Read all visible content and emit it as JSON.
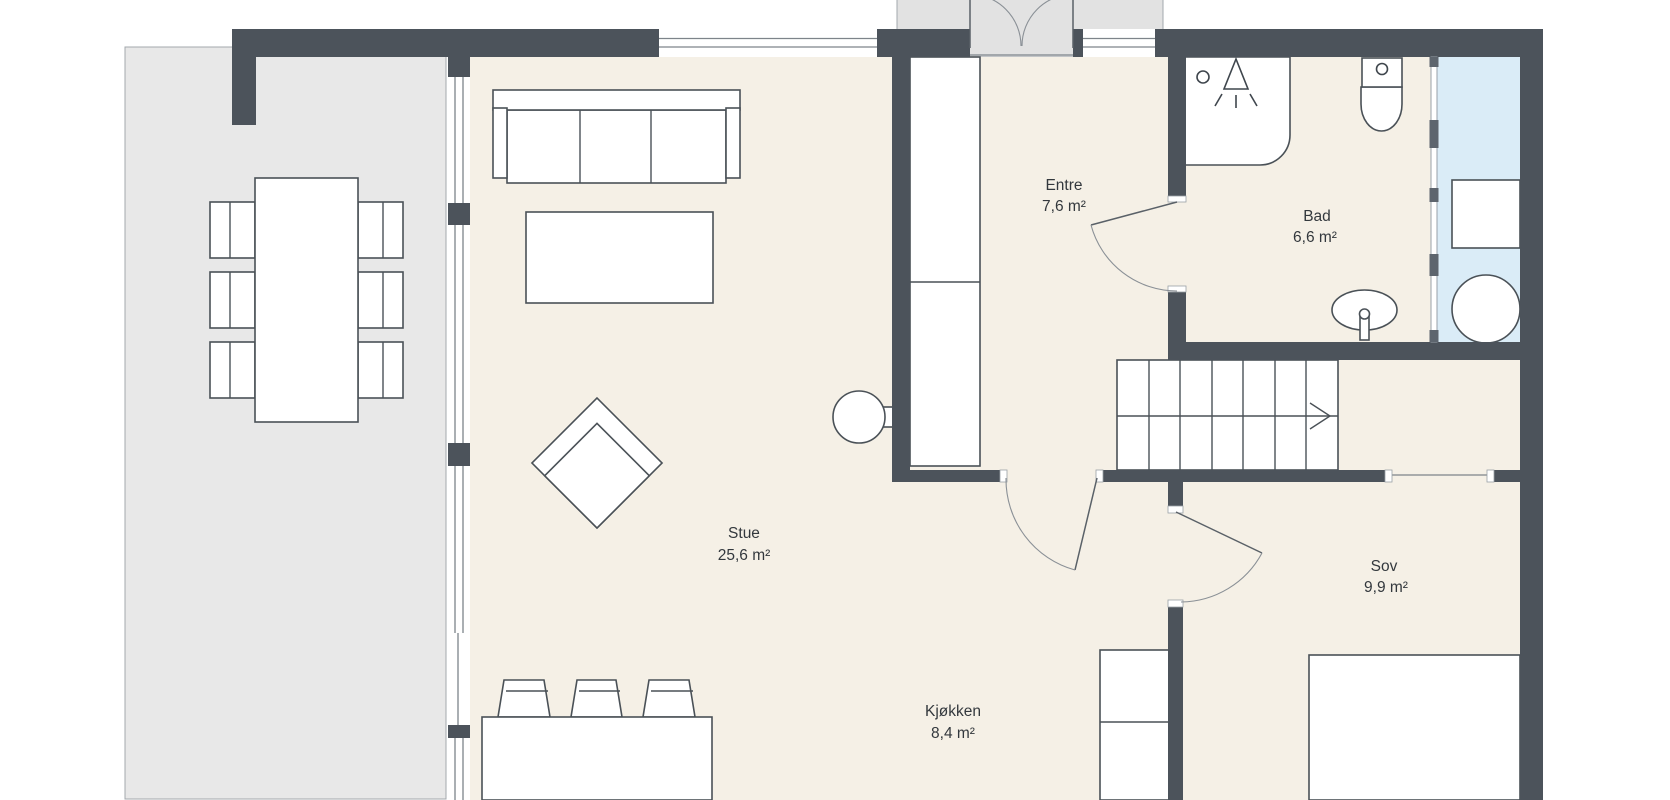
{
  "document": {
    "type": "floor-plan",
    "language": "Norwegian"
  },
  "colors": {
    "wall": "#4c535b",
    "floor": "#f5f0e6",
    "terrace": "#e8e8e8",
    "porch": "#e2e2e2",
    "wet_zone": "#daecf7",
    "furniture_stroke": "#4a5157",
    "detail_line": "#7d848a",
    "text": "#33383d",
    "background": "#ffffff"
  },
  "rooms": [
    {
      "id": "stue",
      "name": "Stue",
      "area": "25,6 m²"
    },
    {
      "id": "kjokken",
      "name": "Kjøkken",
      "area": "8,4 m²"
    },
    {
      "id": "entre",
      "name": "Entre",
      "area": "7,6 m²"
    },
    {
      "id": "bad",
      "name": "Bad",
      "area": "6,6 m²"
    },
    {
      "id": "sov",
      "name": "Sov",
      "area": "9,9 m²"
    }
  ],
  "stairs": {
    "direction_arrow": "right",
    "treads": 7
  },
  "fixtures": [
    "sofa",
    "coffee-table",
    "lounge-chair",
    "side-chair",
    "wardrobe-cabinet",
    "dining-table",
    "dining-chairs-x6",
    "kitchen-island",
    "bar-stools-x3",
    "tall-kitchen-cabinet",
    "bed",
    "shower",
    "toilet",
    "sink",
    "washing-machine",
    "water-heater",
    "glass-partition",
    "stairs"
  ]
}
